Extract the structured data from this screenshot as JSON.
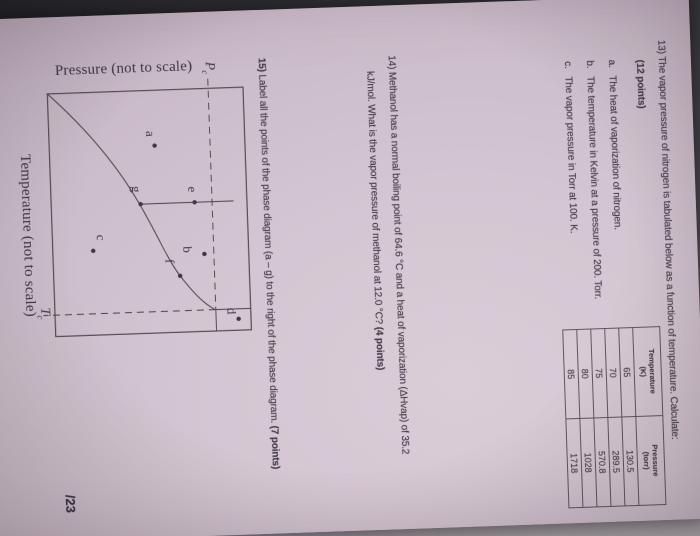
{
  "palette": {
    "paper": "#d3c5d1",
    "ink": "#453c4a",
    "line": "#564c55",
    "background_dark": "#26262b",
    "background_light": "#b3abb1"
  },
  "score_label": "/23",
  "questions": {
    "q13": {
      "line1": "13) The vapor pressure of nitrogen is tabulated below as a function of temperature. Calculate:",
      "points": "(12 points)",
      "items": [
        {
          "letter": "a.",
          "text": "The heat of vaporization of nitrogen."
        },
        {
          "letter": "b.",
          "text": "The temperature in Kelvin at a pressure of 200. Torr."
        },
        {
          "letter": "c.",
          "text": "The vapor pressure in Torr at 100. K."
        }
      ]
    },
    "q14": {
      "line1": "14) Methanol has a normal boiling point of 64.6 °C and a heat of vaporization (ΔHvap) of 35.2",
      "line2": "kJ/mol. What is the vapor pressure of methanol at 12.0 °C? ",
      "points": "(4 points)"
    },
    "q15": {
      "number": "15)",
      "body": " Label all the points of the phase diagram (a – g) to the right of the phase diagram. ",
      "points": "(7 points)"
    }
  },
  "table": {
    "headers": [
      {
        "line1": "Temperature",
        "line2": "(K)"
      },
      {
        "line1": "Pressure",
        "line2": "(torr)"
      }
    ],
    "rows": [
      {
        "temperature_k": "65",
        "pressure_torr": "130.5"
      },
      {
        "temperature_k": "70",
        "pressure_torr": "289.5"
      },
      {
        "temperature_k": "75",
        "pressure_torr": "570.8"
      },
      {
        "temperature_k": "80",
        "pressure_torr": "1028"
      },
      {
        "temperature_k": "85",
        "pressure_torr": "1718"
      }
    ]
  },
  "chart_data": {
    "type": "table",
    "title": "Vapor pressure of nitrogen vs temperature",
    "categories": [
      65,
      70,
      75,
      80,
      85
    ],
    "values": [
      130.5,
      289.5,
      570.8,
      1028,
      1718
    ],
    "xlabel": "Temperature (K)",
    "ylabel": "Pressure (torr)"
  },
  "graph": {
    "y_axis_label": "Pressure (not to scale)",
    "x_axis_label": "Temperature (not to scale)",
    "pc_symbol": "P",
    "tc_symbol": "T",
    "critical_subscript": "c",
    "paths": [
      {
        "name": "vaporization-curve",
        "d": "M0,197 C40,155 80,126 114,108 C150,89 170,82 187,70 C205,57 216,47 222,36",
        "dashed": false
      },
      {
        "name": "fusion-line",
        "d": "M114,108 L114,14",
        "dashed": false
      },
      {
        "name": "pc-dashed-line",
        "d": "M-9,35.5 L222,35.5",
        "dashed": true
      },
      {
        "name": "tc-dashed-line",
        "d": "M222,35.5 L222,208",
        "dashed": true
      },
      {
        "name": "supercritical-box-vertical",
        "d": "M222,0 L222,35.5",
        "dashed": false
      },
      {
        "name": "supercritical-box-horizontal",
        "d": "M222,35.5 L244,35.5",
        "dashed": false
      }
    ],
    "points": [
      {
        "id": "a",
        "dot": [
          56,
          91
        ],
        "label": [
          44,
          99
        ]
      },
      {
        "id": "b",
        "dot": [
          166,
          45
        ],
        "label": [
          161,
          66
        ]
      },
      {
        "id": "c",
        "dot": [
          159,
          156
        ],
        "label": [
          146,
          152
        ]
      },
      {
        "id": "d",
        "dot": [
          232,
          13
        ],
        "label": [
          224,
          24
        ]
      },
      {
        "id": "e",
        "dot": [
          114,
          53
        ],
        "label": [
          101,
          59
        ]
      },
      {
        "id": "f",
        "dot": [
          187,
          70
        ],
        "label": [
          172,
          84
        ]
      },
      {
        "id": "g",
        "dot": [
          114,
          107
        ],
        "label": [
          99,
          115
        ]
      }
    ]
  }
}
